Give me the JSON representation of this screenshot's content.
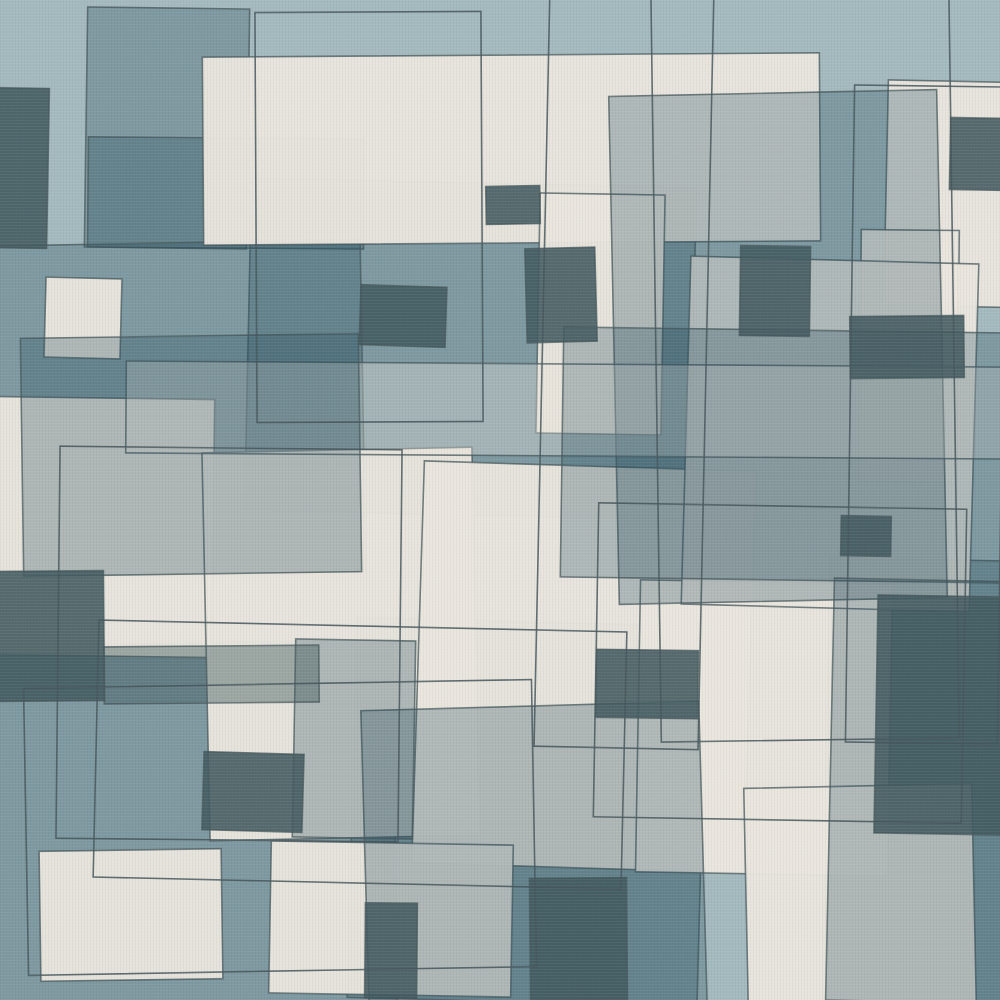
{
  "artwork": {
    "title": "mid-century-abstract-geometric-pattern",
    "canvas": {
      "width": 1000,
      "height": 1000
    },
    "palette": {
      "background": "#a3b9bd",
      "cream": "#eae6de",
      "gray_overlay": "#24495a",
      "dark": "#40585d",
      "outline": "#44555a"
    },
    "style": {
      "stroke_width": 1.6,
      "stroke_opacity": 0.75,
      "outline_only_stroke_opacity": 0.85,
      "noise_opacity": 0.5
    },
    "shapes": [
      {
        "n": "slab-top-left-column",
        "f": "gray",
        "o": 0.29,
        "x": 86,
        "y": 8,
        "w": 162,
        "h": 240,
        "r": 0.8
      },
      {
        "n": "slab-top-left-wide",
        "f": "gray",
        "o": 0.29,
        "x": 88,
        "y": 138,
        "w": 276,
        "h": 110,
        "r": 0.5
      },
      {
        "n": "slab-center",
        "f": "gray",
        "o": 0.29,
        "x": 248,
        "y": 183,
        "w": 445,
        "h": 332,
        "r": 1.2
      },
      {
        "n": "slab-left",
        "f": "gray",
        "o": 0.29,
        "x": -25,
        "y": 243,
        "w": 388,
        "h": 332,
        "r": -1
      },
      {
        "n": "slab-bottom-left",
        "f": "gray",
        "o": 0.29,
        "x": -30,
        "y": 643,
        "w": 425,
        "h": 362,
        "r": -0.8
      },
      {
        "n": "slab-bottom-center",
        "f": "gray",
        "o": 0.29,
        "x": 352,
        "y": 622,
        "w": 350,
        "h": 380,
        "r": 1.5
      },
      {
        "n": "slab-bottom-right",
        "f": "gray",
        "o": 0.29,
        "x": 826,
        "y": 560,
        "w": 235,
        "h": 442,
        "r": 1
      },
      {
        "n": "cream-top-slab",
        "f": "cream",
        "o": 0.96,
        "x": 203,
        "y": 55,
        "w": 617,
        "h": 188,
        "r": -0.4
      },
      {
        "n": "cream-top-right",
        "f": "cream",
        "o": 0.96,
        "x": 886,
        "y": 82,
        "w": 205,
        "h": 225,
        "r": 1.2
      },
      {
        "n": "cream-right-step",
        "f": "cream",
        "o": 0.96,
        "x": 860,
        "y": 230,
        "w": 98,
        "h": 252,
        "r": 0.6
      },
      {
        "n": "cream-center-column",
        "f": "cream",
        "o": 0.96,
        "x": 538,
        "y": 194,
        "w": 125,
        "h": 240,
        "r": 1
      },
      {
        "n": "cream-left-block",
        "f": "cream",
        "o": 0.96,
        "x": -12,
        "y": 398,
        "w": 225,
        "h": 258,
        "r": 0.8
      },
      {
        "n": "cream-small-left",
        "f": "cream",
        "o": 0.96,
        "x": 45,
        "y": 278,
        "w": 76,
        "h": 80,
        "r": 1.5
      },
      {
        "n": "cream-left-center-big",
        "f": "cream",
        "o": 0.96,
        "x": 206,
        "y": 450,
        "w": 270,
        "h": 388,
        "r": -1.2
      },
      {
        "n": "cream-center-big",
        "f": "cream",
        "o": 0.96,
        "x": 418,
        "y": 466,
        "w": 332,
        "h": 402,
        "r": 1.8
      },
      {
        "n": "cream-center-right",
        "f": "cream",
        "o": 0.96,
        "x": 638,
        "y": 582,
        "w": 252,
        "h": 292,
        "r": 1
      },
      {
        "n": "cream-right-tall",
        "f": "cream",
        "o": 0.96,
        "x": 686,
        "y": 260,
        "w": 288,
        "h": 348,
        "r": 1.6
      },
      {
        "n": "cream-bottom-left",
        "f": "cream",
        "o": 0.96,
        "x": 40,
        "y": 850,
        "w": 182,
        "h": 130,
        "r": -0.8
      },
      {
        "n": "cream-bottom-center",
        "f": "cream",
        "o": 0.96,
        "x": 270,
        "y": 843,
        "w": 242,
        "h": 152,
        "r": 1
      },
      {
        "n": "cream-bottom-right",
        "f": "cream",
        "o": 0.96,
        "x": 746,
        "y": 786,
        "w": 228,
        "h": 218,
        "r": -1.2
      },
      {
        "n": "veil-top-right",
        "f": "gray",
        "o": 0.29,
        "x": 614,
        "y": 93,
        "w": 328,
        "h": 508,
        "r": -1.2
      },
      {
        "n": "veil-light-band",
        "f": "cream",
        "o": 0.35,
        "x": 126,
        "y": 364,
        "w": 884,
        "h": 92,
        "r": 0.4
      },
      {
        "n": "veil-left-mid",
        "f": "gray",
        "o": 0.29,
        "x": 22,
        "y": 336,
        "w": 338,
        "h": 238,
        "r": -0.8
      },
      {
        "n": "veil-right-center",
        "f": "gray",
        "o": 0.29,
        "x": 562,
        "y": 330,
        "w": 448,
        "h": 250,
        "r": 0.8
      },
      {
        "n": "veil-bottom-center",
        "f": "gray",
        "o": 0.29,
        "x": 365,
        "y": 706,
        "w": 338,
        "h": 302,
        "r": -1.6
      },
      {
        "n": "veil-bottom-right",
        "f": "gray",
        "o": 0.29,
        "x": 830,
        "y": 580,
        "w": 188,
        "h": 422,
        "r": 1.2
      },
      {
        "n": "veil-column-mid-bottom",
        "f": "gray",
        "o": 0.29,
        "x": 294,
        "y": 640,
        "w": 120,
        "h": 198,
        "r": 1
      },
      {
        "n": "dark-top-left",
        "f": "dark",
        "o": 0.88,
        "x": -10,
        "y": 88,
        "w": 58,
        "h": 160,
        "r": 1
      },
      {
        "n": "dark-top-center-small",
        "f": "dark",
        "o": 0.88,
        "x": 486,
        "y": 186,
        "w": 54,
        "h": 38,
        "r": -1
      },
      {
        "n": "dark-center-upper",
        "f": "dark",
        "o": 0.88,
        "x": 526,
        "y": 248,
        "w": 70,
        "h": 94,
        "r": -1.5
      },
      {
        "n": "dark-left-center",
        "f": "dark",
        "o": 0.88,
        "x": 360,
        "y": 286,
        "w": 86,
        "h": 60,
        "r": 1.8
      },
      {
        "n": "dark-center-right",
        "f": "dark",
        "o": 0.88,
        "x": 740,
        "y": 246,
        "w": 70,
        "h": 90,
        "r": 0.8
      },
      {
        "n": "dark-right-mid",
        "f": "dark",
        "o": 0.88,
        "x": 850,
        "y": 316,
        "w": 114,
        "h": 62,
        "r": -0.6
      },
      {
        "n": "dark-top-right-corner",
        "f": "dark",
        "o": 0.88,
        "x": 950,
        "y": 118,
        "w": 62,
        "h": 72,
        "r": 1
      },
      {
        "n": "dark-left-tall",
        "f": "dark",
        "o": 0.88,
        "x": -6,
        "y": 571,
        "w": 110,
        "h": 130,
        "r": -0.5
      },
      {
        "n": "dark-left-bar",
        "f": "dark",
        "o": 0.45,
        "x": 104,
        "y": 646,
        "w": 215,
        "h": 57,
        "r": -0.5
      },
      {
        "n": "dark-bottom-left-small",
        "f": "dark",
        "o": 0.88,
        "x": 203,
        "y": 753,
        "w": 100,
        "h": 78,
        "r": 1.6
      },
      {
        "n": "dark-center-low",
        "f": "dark",
        "o": 0.88,
        "x": 596,
        "y": 650,
        "w": 102,
        "h": 68,
        "r": 0.8
      },
      {
        "n": "dark-small-right-center",
        "f": "dark",
        "o": 0.88,
        "x": 841,
        "y": 516,
        "w": 50,
        "h": 40,
        "r": 1
      },
      {
        "n": "dark-bottom-center",
        "f": "dark",
        "o": 0.88,
        "x": 530,
        "y": 878,
        "w": 97,
        "h": 122,
        "r": -0.5
      },
      {
        "n": "dark-bottom-center-small",
        "f": "dark",
        "o": 0.88,
        "x": 365,
        "y": 903,
        "w": 52,
        "h": 95,
        "r": 0.5
      },
      {
        "n": "dark-bottom-right-big",
        "f": "dark",
        "o": 0.88,
        "x": 876,
        "y": 596,
        "w": 132,
        "h": 238,
        "r": 1
      },
      {
        "n": "outline-tall-left",
        "f": "none",
        "o": 0,
        "x": 256,
        "y": 12,
        "w": 226,
        "h": 410,
        "r": -0.3
      },
      {
        "n": "outline-center-vertical",
        "f": "none",
        "o": 0,
        "x": 542,
        "y": -12,
        "w": 164,
        "h": 760,
        "r": 1.2
      },
      {
        "n": "outline-right-vertical",
        "f": "none",
        "o": 0,
        "x": 656,
        "y": -22,
        "w": 298,
        "h": 762,
        "r": -0.8
      },
      {
        "n": "outline-bottom-left",
        "f": "none",
        "o": 0,
        "x": 26,
        "y": 684,
        "w": 508,
        "h": 287,
        "r": -1
      },
      {
        "n": "outline-center-right",
        "f": "none",
        "o": 0,
        "x": 596,
        "y": 506,
        "w": 368,
        "h": 314,
        "r": 1
      },
      {
        "n": "outline-bottom-center",
        "f": "none",
        "o": 0,
        "x": 96,
        "y": 626,
        "w": 528,
        "h": 257,
        "r": 1.3
      },
      {
        "n": "outline-right-tall",
        "f": "none",
        "o": 0,
        "x": 850,
        "y": 86,
        "w": 152,
        "h": 657,
        "r": 0.8
      },
      {
        "n": "outline-left-center",
        "f": "none",
        "o": 0,
        "x": 58,
        "y": 448,
        "w": 342,
        "h": 392,
        "r": 0.6
      }
    ]
  }
}
